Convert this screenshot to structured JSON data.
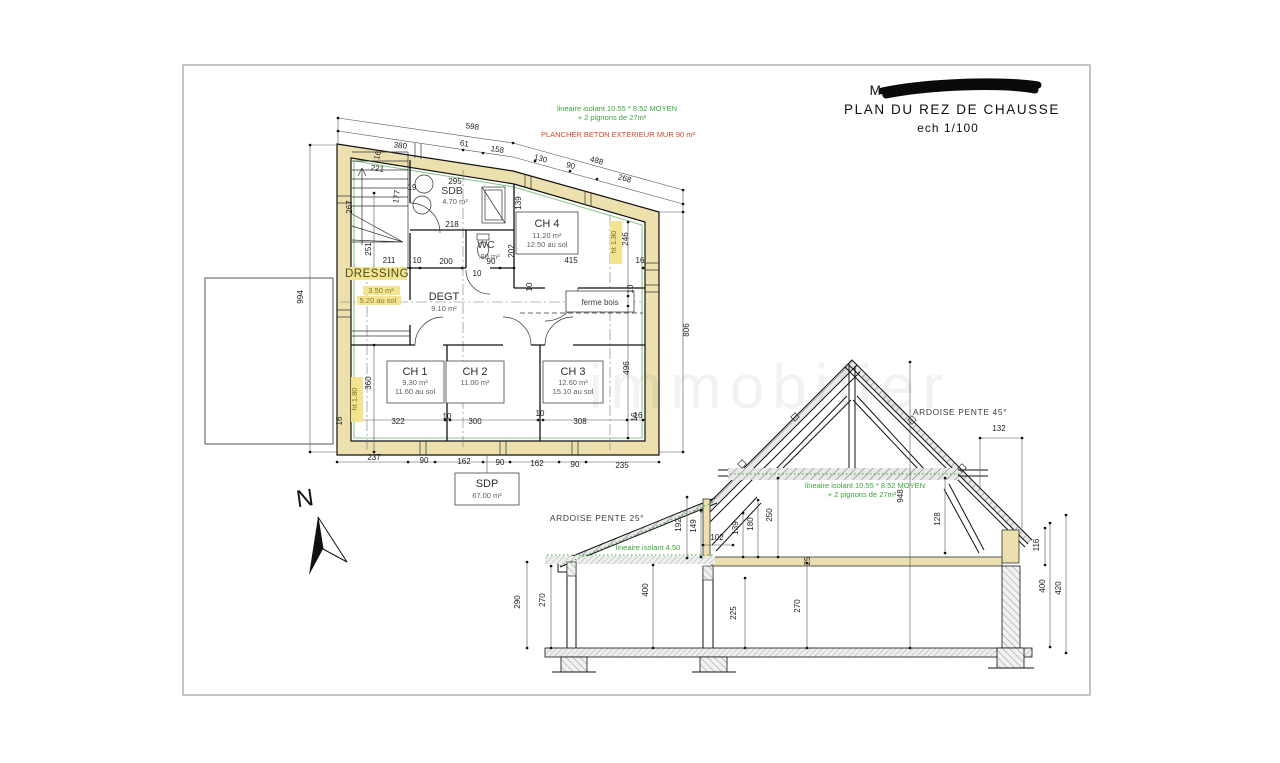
{
  "colors": {
    "wall_fill": "#ece0ae",
    "green_line": "#8cc88c",
    "green_text": "#3aa53a",
    "red_text": "#cc4a28",
    "highlight": "#f3e490",
    "frame": "#8a8a8a"
  },
  "title_block": {
    "masked_name_visible": "M",
    "plan_title": "PLAN DU REZ DE CHAUSSE",
    "scale": "ech 1/100"
  },
  "labels": {
    "title_block": [
      {
        "n": "masked-name",
        "t": "M",
        "x": 876,
        "y": 95,
        "s": "title"
      },
      {
        "n": "plan-title",
        "t": "PLAN DU REZ DE CHAUSSE",
        "x": 952,
        "y": 114,
        "s": "title"
      },
      {
        "n": "plan-scale",
        "t": "ech 1/100",
        "x": 948,
        "y": 132,
        "s": "title2"
      }
    ],
    "plan_annotations": [
      {
        "n": "note-isolant-plan-1",
        "t": "lineaire isolant 10.55 * 8.52 MOYEN",
        "x": 617,
        "y": 111,
        "s": "green"
      },
      {
        "n": "note-isolant-plan-2",
        "t": "+ 2 pignons de 27m²",
        "x": 612,
        "y": 120,
        "s": "green"
      },
      {
        "n": "note-plancher-beton",
        "t": "PLANCHER BETON EXTERIEUR   MUR 90 m²",
        "x": 618,
        "y": 137,
        "s": "red"
      }
    ],
    "plan_rooms": [
      {
        "n": "room-sdb",
        "t": "SDB",
        "x": 452,
        "y": 194,
        "s": "room2"
      },
      {
        "n": "room-sdb-area",
        "t": "4.70 m²",
        "x": 455,
        "y": 204,
        "s": "sub"
      },
      {
        "n": "room-wc",
        "t": "WC",
        "x": 486,
        "y": 248,
        "s": "room2"
      },
      {
        "n": "room-wc-area",
        "t": ".80 m²",
        "x": 489,
        "y": 259,
        "s": "sub"
      },
      {
        "n": "room-ch4",
        "t": "CH 4",
        "x": 547,
        "y": 227,
        "s": "room"
      },
      {
        "n": "room-ch4-area",
        "t": "11.20 m²",
        "x": 547,
        "y": 238,
        "s": "sub"
      },
      {
        "n": "room-ch4-sol",
        "t": "12.50 au sol",
        "x": 547,
        "y": 247,
        "s": "sub"
      },
      {
        "n": "room-dressing",
        "t": "DRESSING",
        "x": 377,
        "y": 277,
        "s": "dressing"
      },
      {
        "n": "room-dressing-area",
        "t": "3.50 m²",
        "x": 381,
        "y": 293,
        "s": "subhl"
      },
      {
        "n": "room-dressing-sol",
        "t": "5.20 au sol",
        "x": 378,
        "y": 303,
        "s": "subhl"
      },
      {
        "n": "room-degt",
        "t": "DEGT",
        "x": 444,
        "y": 300,
        "s": "room"
      },
      {
        "n": "room-degt-area",
        "t": "9.10 m²",
        "x": 444,
        "y": 311,
        "s": "sub"
      },
      {
        "n": "ferme-bois-label",
        "t": "ferme bois",
        "x": 600,
        "y": 305,
        "s": "sub2"
      },
      {
        "n": "room-ch1",
        "t": "CH 1",
        "x": 415,
        "y": 375,
        "s": "room"
      },
      {
        "n": "room-ch1-area",
        "t": "9.30 m²",
        "x": 415,
        "y": 385,
        "s": "sub"
      },
      {
        "n": "room-ch1-sol",
        "t": "11.60 au sol",
        "x": 415,
        "y": 394,
        "s": "sub"
      },
      {
        "n": "room-ch2",
        "t": "CH 2",
        "x": 475,
        "y": 375,
        "s": "room"
      },
      {
        "n": "room-ch2-area",
        "t": "11.00 m²",
        "x": 475,
        "y": 385,
        "s": "sub"
      },
      {
        "n": "room-ch3",
        "t": "CH 3",
        "x": 573,
        "y": 375,
        "s": "room"
      },
      {
        "n": "room-ch3-area",
        "t": "12.60 m²",
        "x": 573,
        "y": 385,
        "s": "sub"
      },
      {
        "n": "room-ch3-sol",
        "t": "15.10 au sol",
        "x": 573,
        "y": 394,
        "s": "sub"
      },
      {
        "n": "room-sdp",
        "t": "SDP",
        "x": 487,
        "y": 487,
        "s": "room"
      },
      {
        "n": "room-sdp-area",
        "t": "67.00 m²",
        "x": 487,
        "y": 498,
        "s": "sub"
      }
    ],
    "plan_dims": [
      {
        "n": "dim",
        "t": "598",
        "x": 472,
        "y": 129,
        "r": 8
      },
      {
        "n": "dim",
        "t": "380",
        "x": 400,
        "y": 148,
        "r": 8
      },
      {
        "n": "dim",
        "t": "61",
        "x": 464,
        "y": 146,
        "r": 8
      },
      {
        "n": "dim",
        "t": "158",
        "x": 497,
        "y": 152,
        "r": 9
      },
      {
        "n": "dim",
        "t": "130",
        "x": 540,
        "y": 161,
        "r": 15
      },
      {
        "n": "dim",
        "t": "90",
        "x": 570,
        "y": 168,
        "r": 15
      },
      {
        "n": "dim",
        "t": "488",
        "x": 596,
        "y": 163,
        "r": 15
      },
      {
        "n": "dim",
        "t": "268",
        "x": 624,
        "y": 181,
        "r": 15
      },
      {
        "n": "dim",
        "t": "16",
        "x": 380,
        "y": 156,
        "r": -75
      },
      {
        "n": "dim",
        "t": "221",
        "x": 377,
        "y": 171,
        "r": 8
      },
      {
        "n": "dim",
        "t": "295",
        "x": 455,
        "y": 184
      },
      {
        "n": "dim",
        "t": "218",
        "x": 452,
        "y": 227
      },
      {
        "n": "dim",
        "t": "177",
        "x": 399,
        "y": 197,
        "r": -82
      },
      {
        "n": "dim",
        "t": "19",
        "x": 412,
        "y": 190
      },
      {
        "n": "dim",
        "t": "139",
        "x": 521,
        "y": 203,
        "r": -90
      },
      {
        "n": "dim",
        "t": "267",
        "x": 352,
        "y": 207,
        "r": -90
      },
      {
        "n": "dim",
        "t": "251",
        "x": 371,
        "y": 249,
        "r": -90
      },
      {
        "n": "dim",
        "t": "211",
        "x": 389,
        "y": 263
      },
      {
        "n": "dim",
        "t": "10",
        "x": 417,
        "y": 263
      },
      {
        "n": "dim",
        "t": "200",
        "x": 446,
        "y": 264
      },
      {
        "n": "dim",
        "t": "90",
        "x": 491,
        "y": 264
      },
      {
        "n": "dim",
        "t": "10",
        "x": 477,
        "y": 276
      },
      {
        "n": "dim",
        "t": "202",
        "x": 514,
        "y": 251,
        "r": -90
      },
      {
        "n": "dim",
        "t": "415",
        "x": 571,
        "y": 263
      },
      {
        "n": "dim",
        "t": "16",
        "x": 640,
        "y": 263
      },
      {
        "n": "dim-ht",
        "t": "ht 1.80",
        "x": 616,
        "y": 242,
        "r": -90,
        "s": "dimhl"
      },
      {
        "n": "dim",
        "t": "246",
        "x": 628,
        "y": 239,
        "r": -90
      },
      {
        "n": "dim",
        "t": "10",
        "x": 532,
        "y": 287,
        "r": -90
      },
      {
        "n": "dim",
        "t": "10",
        "x": 633,
        "y": 289,
        "r": -90
      },
      {
        "n": "dim",
        "t": "496",
        "x": 629,
        "y": 368,
        "r": -90
      },
      {
        "n": "dim",
        "t": "16",
        "x": 637,
        "y": 417,
        "r": -90
      },
      {
        "n": "dim",
        "t": "360",
        "x": 371,
        "y": 383,
        "r": -90
      },
      {
        "n": "dim-ht",
        "t": "ht 1.80",
        "x": 357,
        "y": 399,
        "r": -90,
        "s": "dimhl"
      },
      {
        "n": "dim",
        "t": "806",
        "x": 689,
        "y": 330,
        "r": -90
      },
      {
        "n": "dim",
        "t": "994",
        "x": 303,
        "y": 297,
        "r": -90
      },
      {
        "n": "dim",
        "t": "322",
        "x": 398,
        "y": 424
      },
      {
        "n": "dim",
        "t": "10",
        "x": 447,
        "y": 419
      },
      {
        "n": "dim",
        "t": "300",
        "x": 475,
        "y": 424
      },
      {
        "n": "dim",
        "t": "10",
        "x": 540,
        "y": 416
      },
      {
        "n": "dim",
        "t": "308",
        "x": 580,
        "y": 424
      },
      {
        "n": "dim",
        "t": "16",
        "x": 638,
        "y": 418
      },
      {
        "n": "dim",
        "t": "16",
        "x": 342,
        "y": 421,
        "r": -90
      },
      {
        "n": "dim",
        "t": "237",
        "x": 374,
        "y": 460
      },
      {
        "n": "dim",
        "t": "90",
        "x": 424,
        "y": 463
      },
      {
        "n": "dim",
        "t": "162",
        "x": 464,
        "y": 464
      },
      {
        "n": "dim",
        "t": "90",
        "x": 500,
        "y": 465
      },
      {
        "n": "dim",
        "t": "162",
        "x": 537,
        "y": 466
      },
      {
        "n": "dim",
        "t": "90",
        "x": 575,
        "y": 467
      },
      {
        "n": "dim",
        "t": "235",
        "x": 622,
        "y": 468
      }
    ],
    "section_texts": [
      {
        "n": "ardoise-pente-45",
        "t": "ARDOISE PENTE 45°",
        "x": 960,
        "y": 415,
        "s": "note"
      },
      {
        "n": "ardoise-pente-25",
        "t": "ARDOISE PENTE 25°",
        "x": 597,
        "y": 521,
        "s": "note"
      },
      {
        "n": "note-isolant-section-1",
        "t": "lineaire isolant 10.55 * 8.52 MOYEN",
        "x": 865,
        "y": 488,
        "s": "green"
      },
      {
        "n": "note-isolant-section-2",
        "t": "+ 2 pignons de 27m²",
        "x": 862,
        "y": 497,
        "s": "green"
      },
      {
        "n": "note-isolant-450",
        "t": "lineaire isolant 4.50",
        "x": 648,
        "y": 550,
        "s": "green"
      }
    ],
    "section_dims": [
      {
        "n": "dim",
        "t": "948",
        "x": 903,
        "y": 496,
        "r": -90
      },
      {
        "n": "dim",
        "t": "132",
        "x": 999,
        "y": 431
      },
      {
        "n": "dim",
        "t": "192",
        "x": 681,
        "y": 525,
        "r": -90
      },
      {
        "n": "dim",
        "t": "149",
        "x": 696,
        "y": 526,
        "r": -90
      },
      {
        "n": "dim",
        "t": "102",
        "x": 717,
        "y": 540
      },
      {
        "n": "dim",
        "t": "139",
        "x": 738,
        "y": 528,
        "r": -90
      },
      {
        "n": "dim",
        "t": "180",
        "x": 753,
        "y": 524,
        "r": -90
      },
      {
        "n": "dim",
        "t": "250",
        "x": 772,
        "y": 515,
        "r": -90
      },
      {
        "n": "dim",
        "t": "128",
        "x": 940,
        "y": 519,
        "r": -90
      },
      {
        "n": "dim",
        "t": "116",
        "x": 1039,
        "y": 545,
        "r": -90
      },
      {
        "n": "dim",
        "t": "400",
        "x": 1045,
        "y": 586,
        "r": -90
      },
      {
        "n": "dim",
        "t": "420",
        "x": 1061,
        "y": 588,
        "r": -90
      },
      {
        "n": "dim",
        "t": "290",
        "x": 520,
        "y": 602,
        "r": -90
      },
      {
        "n": "dim",
        "t": "270",
        "x": 545,
        "y": 600,
        "r": -90
      },
      {
        "n": "dim",
        "t": "400",
        "x": 648,
        "y": 590,
        "r": -90
      },
      {
        "n": "dim",
        "t": "225",
        "x": 736,
        "y": 613,
        "r": -90
      },
      {
        "n": "dim",
        "t": "270",
        "x": 800,
        "y": 606,
        "r": -90
      },
      {
        "n": "dim",
        "t": "25",
        "x": 810,
        "y": 561,
        "r": -90
      }
    ],
    "north": [
      {
        "n": "north-letter",
        "t": "N",
        "x": 306,
        "y": 506,
        "s": "north",
        "r": -8
      }
    ],
    "watermark": [
      {
        "n": "watermark",
        "t": "immobilier",
        "x": 770,
        "y": 408,
        "s": "wm"
      }
    ]
  }
}
